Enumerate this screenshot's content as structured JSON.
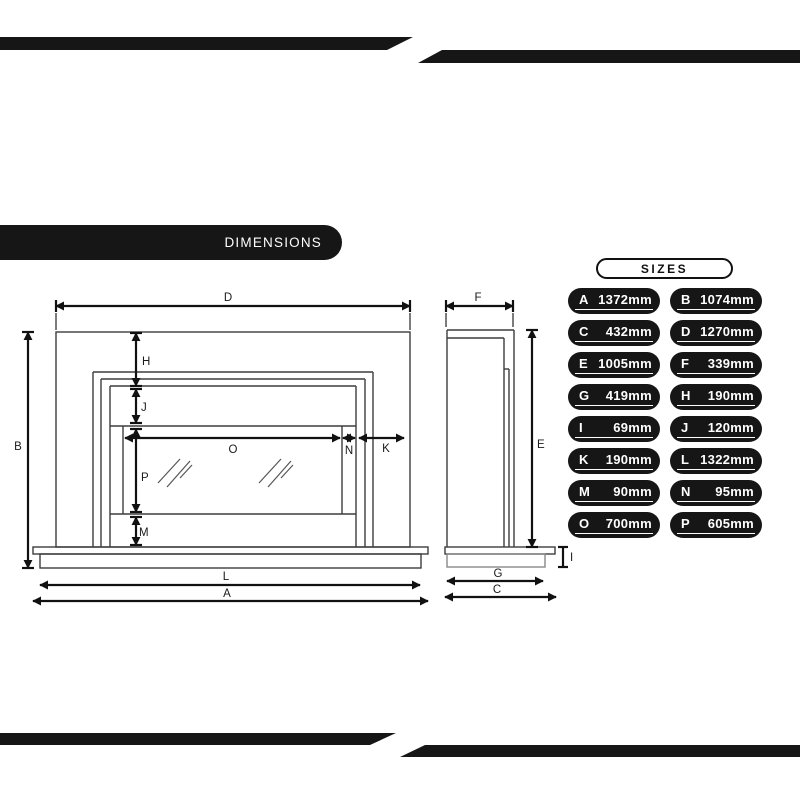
{
  "dimensions_pill": {
    "label": "DIMENSIONS"
  },
  "sizes_panel": {
    "title": "SIZES",
    "rows": [
      {
        "letter": "A",
        "value": "1372mm"
      },
      {
        "letter": "B",
        "value": "1074mm"
      },
      {
        "letter": "C",
        "value": "432mm"
      },
      {
        "letter": "D",
        "value": "1270mm"
      },
      {
        "letter": "E",
        "value": "1005mm"
      },
      {
        "letter": "F",
        "value": "339mm"
      },
      {
        "letter": "G",
        "value": "419mm"
      },
      {
        "letter": "H",
        "value": "190mm"
      },
      {
        "letter": "I",
        "value": "69mm"
      },
      {
        "letter": "J",
        "value": "120mm"
      },
      {
        "letter": "K",
        "value": "190mm"
      },
      {
        "letter": "L",
        "value": "1322mm"
      },
      {
        "letter": "M",
        "value": "90mm"
      },
      {
        "letter": "N",
        "value": "95mm"
      },
      {
        "letter": "O",
        "value": "700mm"
      },
      {
        "letter": "P",
        "value": "605mm"
      }
    ]
  },
  "drawing": {
    "labels": {
      "A": "A",
      "B": "B",
      "C": "C",
      "D": "D",
      "E": "E",
      "F": "F",
      "G": "G",
      "H": "H",
      "I": "I",
      "J": "J",
      "K": "K",
      "L": "L",
      "M": "M",
      "N": "N",
      "O": "O",
      "P": "P"
    }
  },
  "colors": {
    "ink": "#161616",
    "drawing_line": "#3d3d3d",
    "dimension_line": "#111111",
    "background": "#ffffff",
    "pill_text": "#ffffff"
  }
}
